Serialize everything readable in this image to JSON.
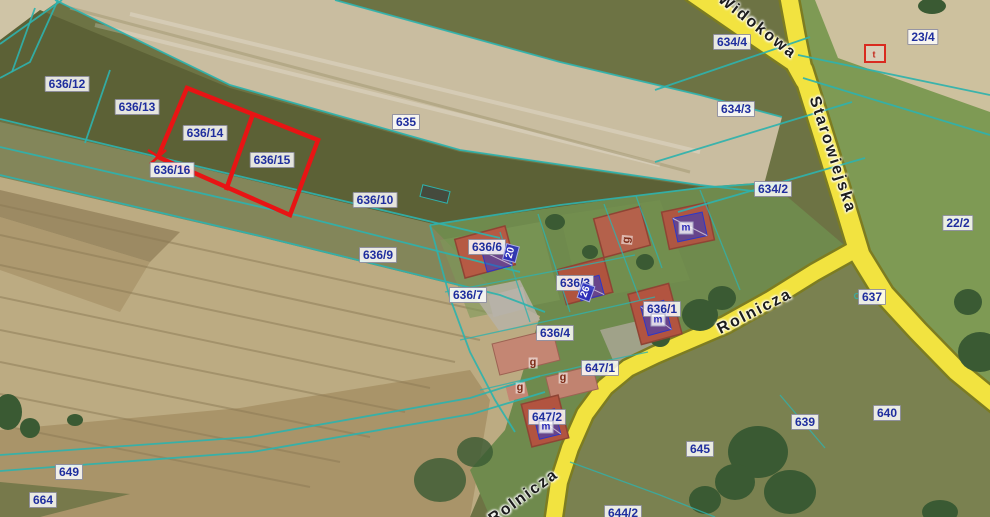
{
  "map": {
    "width": 990,
    "height": 517,
    "colors": {
      "boundary": "#2fb2ac",
      "highlight": "#e81414",
      "road-fill": "#f2e340",
      "road-edge": "#7c7c22",
      "parcel-text": "#1f2e9e",
      "street-text": "#1c1c1c",
      "address-bg": "rgba(40,45,190,.88)",
      "address-text": "#ffffff",
      "m-text": "#2a2ab8",
      "g-text": "#7c2a16"
    },
    "selected_parcels": [
      "636/14",
      "636/15"
    ],
    "labels": [
      {
        "kind": "parcel",
        "text": "636/12",
        "x": 67,
        "y": 84
      },
      {
        "kind": "parcel",
        "text": "636/13",
        "x": 137,
        "y": 107
      },
      {
        "kind": "parcel",
        "text": "636/14",
        "x": 205,
        "y": 133
      },
      {
        "kind": "parcel",
        "text": "636/15",
        "x": 272,
        "y": 160
      },
      {
        "kind": "parcel",
        "text": "636/16",
        "x": 172,
        "y": 170
      },
      {
        "kind": "parcel",
        "text": "635",
        "x": 406,
        "y": 122
      },
      {
        "kind": "parcel",
        "text": "636/10",
        "x": 375,
        "y": 200
      },
      {
        "kind": "parcel",
        "text": "636/9",
        "x": 378,
        "y": 255
      },
      {
        "kind": "parcel",
        "text": "636/6",
        "x": 487,
        "y": 247
      },
      {
        "kind": "parcel",
        "text": "636/7",
        "x": 468,
        "y": 295
      },
      {
        "kind": "parcel",
        "text": "636/3",
        "x": 575,
        "y": 283
      },
      {
        "kind": "parcel",
        "text": "636/4",
        "x": 555,
        "y": 333
      },
      {
        "kind": "parcel",
        "text": "636/1",
        "x": 662,
        "y": 309
      },
      {
        "kind": "parcel",
        "text": "647/1",
        "x": 600,
        "y": 368
      },
      {
        "kind": "parcel",
        "text": "647/2",
        "x": 547,
        "y": 417
      },
      {
        "kind": "parcel",
        "text": "634/4",
        "x": 732,
        "y": 42
      },
      {
        "kind": "parcel",
        "text": "634/3",
        "x": 736,
        "y": 109
      },
      {
        "kind": "parcel",
        "text": "634/2",
        "x": 773,
        "y": 189
      },
      {
        "kind": "parcel",
        "text": "23/4",
        "x": 923,
        "y": 37
      },
      {
        "kind": "parcel",
        "text": "22/2",
        "x": 958,
        "y": 223
      },
      {
        "kind": "parcel",
        "text": "637",
        "x": 872,
        "y": 297
      },
      {
        "kind": "parcel",
        "text": "640",
        "x": 887,
        "y": 413
      },
      {
        "kind": "parcel",
        "text": "639",
        "x": 805,
        "y": 422
      },
      {
        "kind": "parcel",
        "text": "645",
        "x": 700,
        "y": 449
      },
      {
        "kind": "parcel",
        "text": "644/2",
        "x": 623,
        "y": 513
      },
      {
        "kind": "parcel",
        "text": "649",
        "x": 69,
        "y": 472
      },
      {
        "kind": "parcel",
        "text": "664",
        "x": 43,
        "y": 500
      },
      {
        "kind": "street",
        "text": "Widokowa",
        "x": 757,
        "y": 27,
        "rot": 38
      },
      {
        "kind": "street",
        "text": "Starowiejska",
        "x": 832,
        "y": 155,
        "rot": 72
      },
      {
        "kind": "street",
        "text": "Rolnicza",
        "x": 755,
        "y": 312,
        "rot": -27
      },
      {
        "kind": "street",
        "text": "Rolnicza",
        "x": 524,
        "y": 497,
        "rot": -36
      },
      {
        "kind": "address",
        "text": "20",
        "x": 511,
        "y": 253,
        "rot": -75
      },
      {
        "kind": "address",
        "text": "26",
        "x": 586,
        "y": 292,
        "rot": -70
      },
      {
        "kind": "bm",
        "text": "m",
        "x": 686,
        "y": 228
      },
      {
        "kind": "bm",
        "text": "m",
        "x": 658,
        "y": 320
      },
      {
        "kind": "bm",
        "text": "m",
        "x": 546,
        "y": 427
      },
      {
        "kind": "bg",
        "text": "g",
        "x": 627,
        "y": 240,
        "rot": -85
      },
      {
        "kind": "bg",
        "text": "g",
        "x": 533,
        "y": 363
      },
      {
        "kind": "bg",
        "text": "g",
        "x": 563,
        "y": 378
      },
      {
        "kind": "bg",
        "text": "g",
        "x": 520,
        "y": 388
      },
      {
        "kind": "br",
        "text": "t",
        "x": 874,
        "y": 55
      }
    ]
  }
}
